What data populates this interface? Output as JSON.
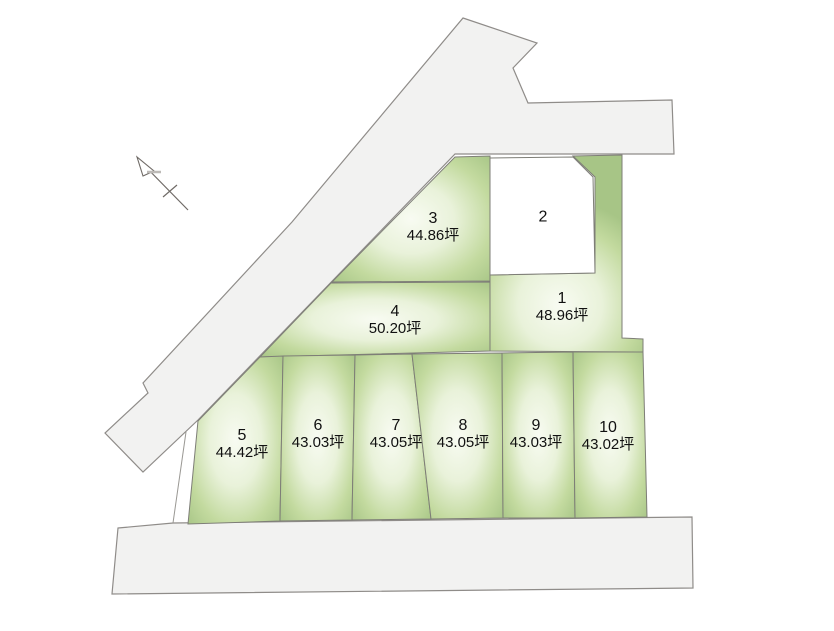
{
  "map": {
    "type": "residential-lot-plan",
    "unit_suffix": "坪",
    "parcels": [
      {
        "number": "1",
        "area": "48.96坪"
      },
      {
        "number": "2",
        "area": ""
      },
      {
        "number": "3",
        "area": "44.86坪"
      },
      {
        "number": "4",
        "area": "50.20坪"
      },
      {
        "number": "5",
        "area": "44.42坪"
      },
      {
        "number": "6",
        "area": "43.03坪"
      },
      {
        "number": "7",
        "area": "43.05坪"
      },
      {
        "number": "8",
        "area": "43.05坪"
      },
      {
        "number": "9",
        "area": "43.03坪"
      },
      {
        "number": "10",
        "area": "43.02坪"
      }
    ],
    "colors": {
      "road_fill": "#f2f2f1",
      "road_stroke": "#8f8c89",
      "parcel_green_edge": "#a9c688",
      "parcel_green_mid": "#dcebc8",
      "parcel_green_center": "#f7faf1",
      "parcel_stroke": "#7e7e77",
      "parcel_white": "#ffffff",
      "label_text": "#111111",
      "background": "#ffffff"
    }
  }
}
